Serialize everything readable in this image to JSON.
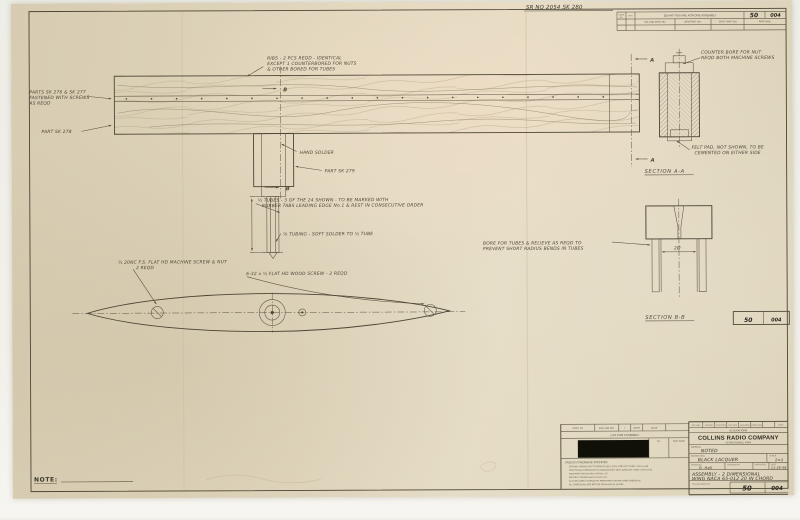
{
  "top": {
    "sr_no": "SR NO 2054 SK 280"
  },
  "table": {
    "header": "QUANTITIES ARE FOR ONE ASSEMBLY",
    "mark_col": "MARK",
    "mark_col2": "NO.",
    "per_col": "PER",
    "col1": "COLLINS PART NO.",
    "col2": "MFG PART NO.",
    "col3": "GOVT PART NO.",
    "part_nos_label": "PART NOS.",
    "part_left": "50",
    "part_right": "004"
  },
  "ann": {
    "ribs": [
      "RIBS - 2 PCS REQD - IDENTICAL",
      "EXCEPT 1 COUNTERBORED FOR NUTS",
      "& OTHER BORED FOR TUBES"
    ],
    "parts_276": [
      "PARTS SK 276 & SK 277",
      "FASTENED WITH SCREWS",
      "AS REQD"
    ],
    "part_278": "PART SK 278",
    "hand_solder": "HAND SOLDER",
    "part_279": "PART SK 279",
    "tubes": [
      "½ TUBES - 3 OF THE 24 SHOWN - TO BE MARKED WITH",
      "RUBBER TABS  LEADING EDGE No.1 & REST IN CONSECUTIVE ORDER"
    ],
    "tubing": "⅛ TUBING - SOFT SOLDER TO ½ TUBE",
    "machine_screw": [
      "¼ 20NC F.S. FLAT HD MACHINE SCREW & NUT",
      "2 REQD"
    ],
    "wood_screw": "6-32 x ½ FLAT HD WOOD SCREW - 2 REQD",
    "bore": [
      "BORE FOR TUBES & RELIEVE AS REQD TO",
      "PREVENT SHORT RADIUS BENDS IN TUBES"
    ],
    "counter_bore": [
      "COUNTER BORE FOR NUT",
      "REQD BOTH MACHINE SCREWS"
    ],
    "felt_pad": [
      "FELT PAD, NOT SHOWN, TO BE",
      "CEMENTED ON EITHER SIDE"
    ],
    "section_aa": "SECTION A-A",
    "section_bb": "SECTION B-B",
    "dim_bb": "2Ø",
    "marker_a": "A",
    "marker_b": "B",
    "note_label": "NOTE:"
  },
  "midbox": {
    "left": "50",
    "right": "004"
  },
  "tb": {
    "left": {
      "row1": [
        "COPY TO",
        "FOLLOW SHT",
        "7",
        "NOTE",
        "DATE"
      ],
      "list_for_assembly": "LIST FOR ASSEMBLY",
      "col_no": "NO.",
      "col_part_name": "PART NAME",
      "tolerance_heading": "UNLESS OTHERWISE SPECIFIED",
      "tolerance_lines": [
        "DECIMAL DIMENSIONS TOLERANCE HELD WITH SIZES NOT OVER 1 INCH ±.005",
        "FRACTIONAL DIMENSIONS TOLERANCE HELD WITH SIZES NOT OVER 1 INCH ±1/64",
        "MACHINED ANGLES HELD WITHIN ±1/2°",
        "BROKEN CORNERS AND FILLETS 1/64",
        "ACCUMULATED TOLERANCES PERMITTED FOR THE SAME DIMENSION",
        "ALL DIMENSIONS ARE BEFORE FINISH AND IN INCHES"
      ]
    },
    "right": {
      "approvals": [
        "DFTSMN",
        "TRACER",
        "CHECKER",
        "DES APP",
        "MFG ENG",
        "PROJ ENG",
        "DATE"
      ],
      "alterations": "ALTERATIONS",
      "company": "COLLINS RADIO COMPANY",
      "city": "CEDAR RAPIDS, IOWA",
      "material_label": "MATERIAL",
      "material": "NOTED",
      "protection_label": "PROTECTION",
      "protection": "BLACK LACQUER",
      "scale_label": "SCALE",
      "scale": "1=1",
      "drawn_label": "DRAWN BY",
      "drawn": "G. Hall",
      "checked_label": "CHECKED BY",
      "approved_label": "APPROVED",
      "date_label": "DATE",
      "date": "11-26-58",
      "title_line1": "ASSEMBLY - 2 DIMENSIONAL",
      "title_line2": "WING NACA 65-012  20 IN CHORD",
      "part_label": "COLLINS PART NO.",
      "part_left": "50",
      "part_right": "004"
    }
  }
}
